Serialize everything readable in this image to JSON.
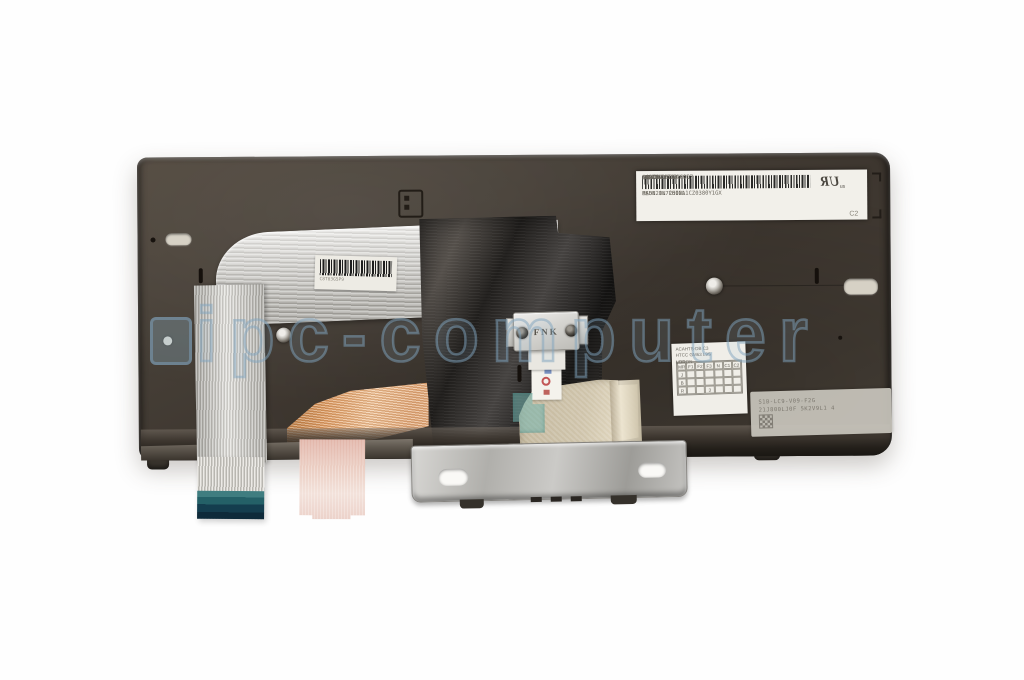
{
  "photo": {
    "watermark": {
      "text": "ipc-computer"
    },
    "colors": {
      "watermark_blue": "#80a3be",
      "keyboard_body": "#433c34",
      "teal_connector": "#246067",
      "copper_cable": "#e2a36b"
    },
    "part_label": {
      "pn_label": "P/NO",
      "pn": "SN20L72602",
      "sn_label": "S/NO",
      "sn": "886107",
      "rev": "REV:B 0E",
      "ul_mark": "UR",
      "ul_sub": "us",
      "fru": "FRU NO. 01AX997",
      "model": "MODEL FU2060L",
      "barcode_text": "8S5N20L72602L1CZ0380Y1GX",
      "origin": "MADE IN CHINA",
      "corner_code": "C2"
    },
    "fnk_bracket": {
      "label": "FNK"
    },
    "cable_sticker": {
      "code": "C8T03G5P9"
    },
    "etched_label": {
      "line1": "S1B-LC9-V09-F2G",
      "line2": "21J800LJ0F 5K2V9L1 4"
    },
    "qc_label": {
      "line1": "ACAHTS-DB C3",
      "line2": "HTCC GM63 L9S",
      "col_left": "VDR",
      "col_right": "L/TRON",
      "grid": {
        "header": [
          "MR",
          "F1",
          "F2",
          "F3",
          "N",
          "C1",
          "C2"
        ],
        "rows": [
          {
            "label": "J",
            "cells": [
              "",
              "",
              "",
              "",
              "",
              ""
            ]
          },
          {
            "label": "B",
            "cells": [
              "",
              "",
              "",
              "",
              "",
              ""
            ]
          },
          {
            "label": "R",
            "cells": [
              "",
              "",
              "3",
              "",
              "",
              ""
            ]
          }
        ]
      }
    }
  }
}
